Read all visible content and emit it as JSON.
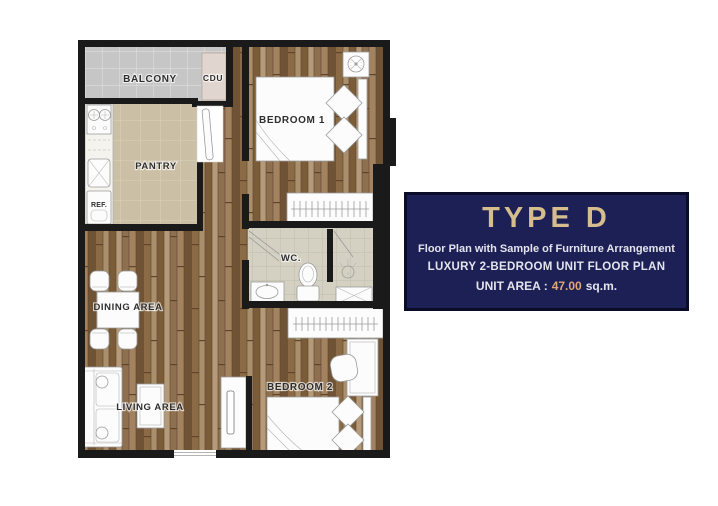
{
  "floor_plan": {
    "labels": {
      "balcony": "BALCONY",
      "cdu": "CDU",
      "bedroom1": "BEDROOM 1",
      "pantry": "PANTRY",
      "ref": "REF.",
      "wc": "WC.",
      "dining": "DINING AREA",
      "living": "LIVING AREA",
      "bedroom2": "BEDROOM 2"
    }
  },
  "info_panel": {
    "title": "TYPE D",
    "subtitle": "Floor Plan with Sample of Furniture Arrangement",
    "plan_type": "LUXURY 2-BEDROOM UNIT FLOOR PLAN",
    "area_label": "UNIT AREA :",
    "area_value": "47.00",
    "area_unit": "sq.m."
  },
  "colors": {
    "panel_bg": "#1d2055",
    "panel_border": "#0b0c28",
    "panel_title": "#d6bd8e",
    "panel_text": "#e4e4ee",
    "panel_accent": "#dfa772",
    "wall": "#1a1a1a"
  }
}
